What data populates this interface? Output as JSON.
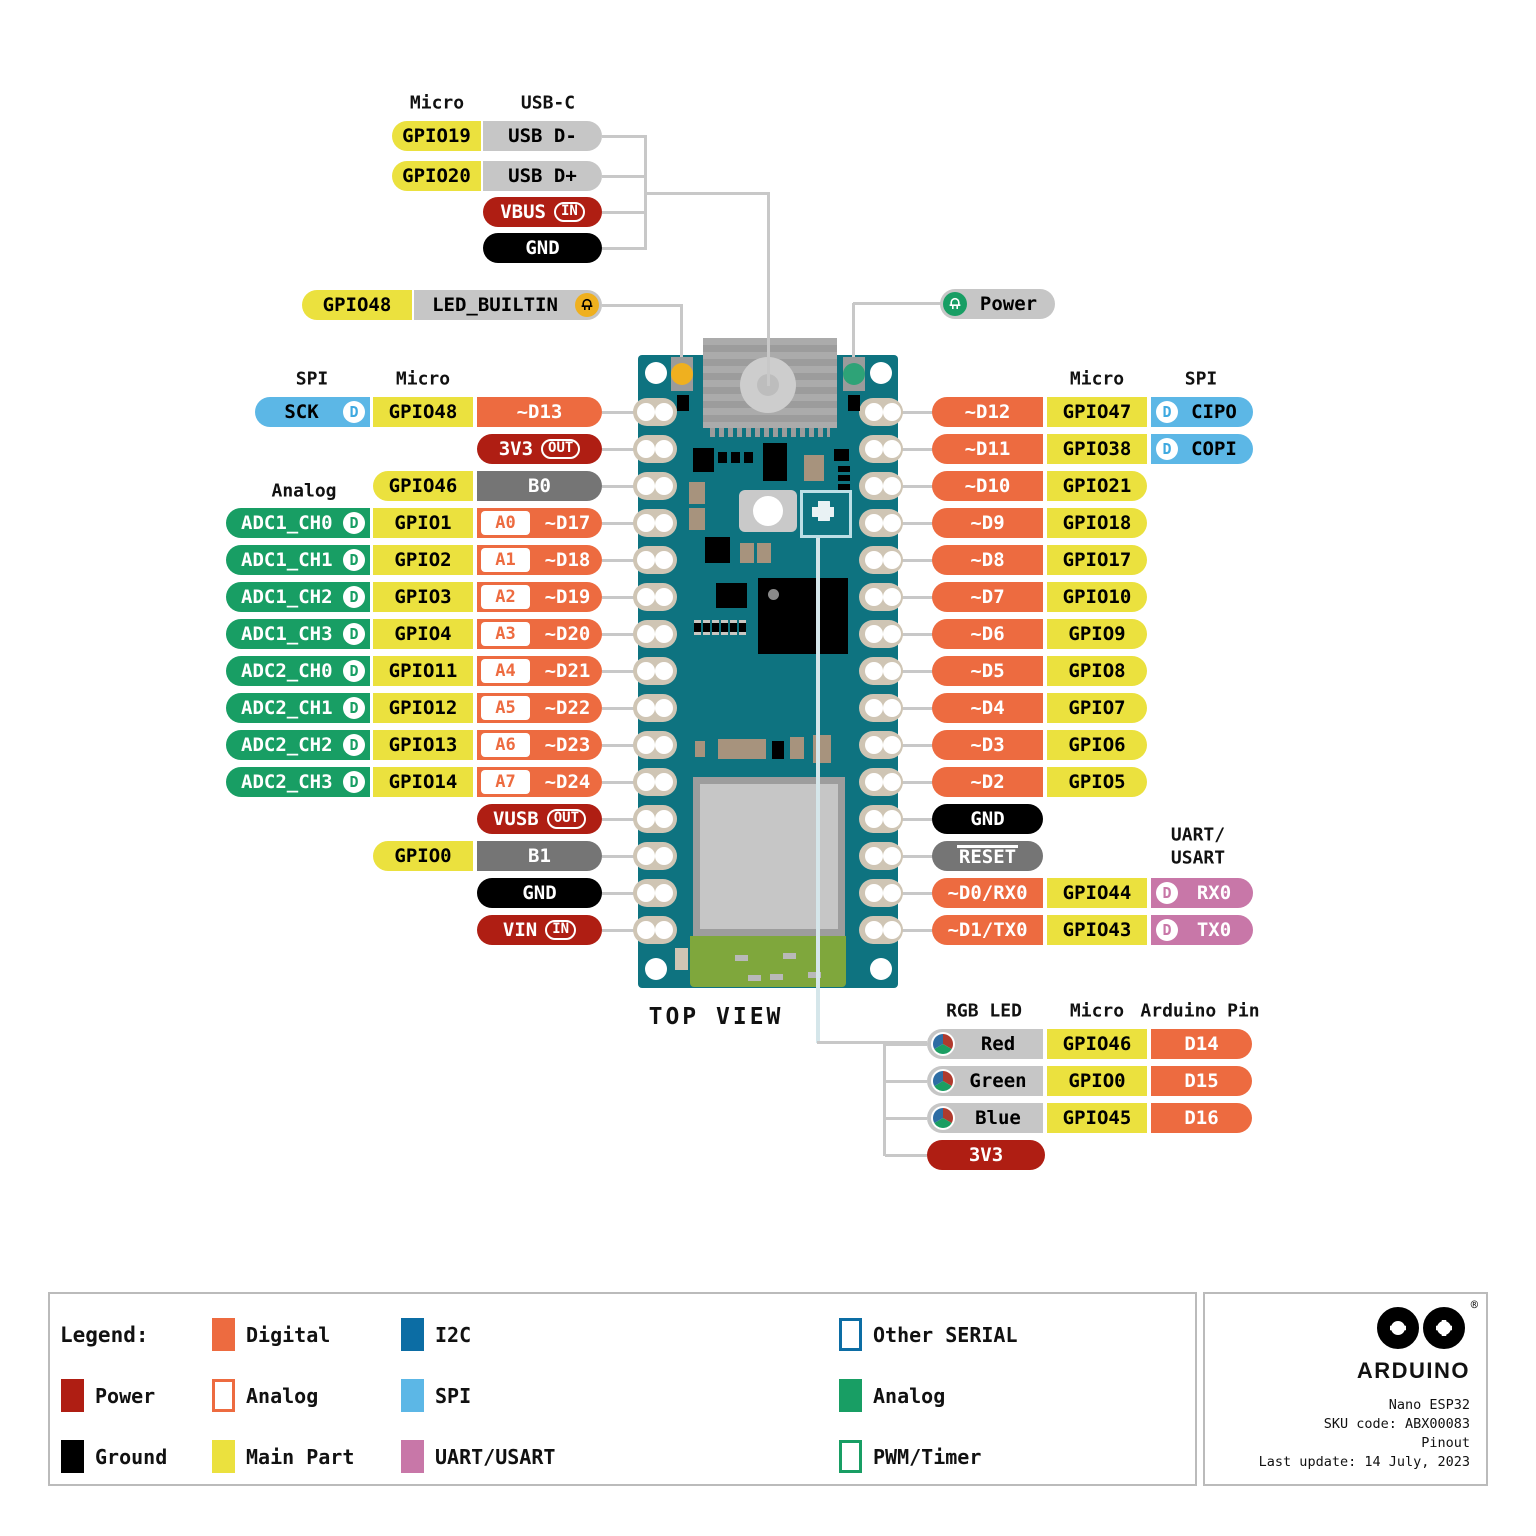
{
  "colors": {
    "digital": "#ED6B40",
    "main_part": "#EBE13E",
    "analog": "#189E64",
    "power": "#AF1E13",
    "ground": "#000000",
    "neutral_gray": "#757575",
    "label_gray": "#C6C6C6",
    "spi": "#5CB7E6",
    "i2c": "#0C6DA4",
    "uart": "#C877A8",
    "board_teal": "#0E7380",
    "wire_gray": "#C8C8C8",
    "pad_tan": "#CFC5B4",
    "led_amber": "#EFB01F",
    "led_green": "#2EA377",
    "antenna_green": "#7FA73C"
  },
  "top": {
    "col_headers": [
      "Micro",
      "USB-C"
    ],
    "rows": [
      {
        "micro": "GPIO19",
        "pin": "USB D-",
        "type": "gray"
      },
      {
        "micro": "GPIO20",
        "pin": "USB D+",
        "type": "gray"
      },
      {
        "pin": "VBUS",
        "badge": "IN",
        "type": "power"
      },
      {
        "pin": "GND",
        "type": "ground"
      }
    ],
    "led_row": {
      "micro": "GPIO48",
      "pin": "LED_BUILTIN"
    },
    "power_pill": "Power"
  },
  "left": {
    "group_headers": {
      "spi": "SPI",
      "micro": "Micro",
      "analog": "Analog"
    },
    "rows": [
      {
        "bus": "SCK",
        "bus_type": "spi",
        "micro": "GPIO48",
        "pin": "~D13"
      },
      {
        "pin": "3V3",
        "badge": "OUT",
        "type": "power"
      },
      {
        "micro": "GPIO46",
        "pin": "B0",
        "type": "gray2"
      },
      {
        "bus": "ADC1_CH0",
        "bus_type": "analog",
        "micro": "GPIO1",
        "abox": "A0",
        "pin": "~D17"
      },
      {
        "bus": "ADC1_CH1",
        "bus_type": "analog",
        "micro": "GPIO2",
        "abox": "A1",
        "pin": "~D18"
      },
      {
        "bus": "ADC1_CH2",
        "bus_type": "analog",
        "micro": "GPIO3",
        "abox": "A2",
        "pin": "~D19"
      },
      {
        "bus": "ADC1_CH3",
        "bus_type": "analog",
        "micro": "GPIO4",
        "abox": "A3",
        "pin": "~D20"
      },
      {
        "bus": "ADC2_CH0",
        "bus_type": "analog",
        "micro": "GPIO11",
        "abox": "A4",
        "pin": "~D21"
      },
      {
        "bus": "ADC2_CH1",
        "bus_type": "analog",
        "micro": "GPIO12",
        "abox": "A5",
        "pin": "~D22"
      },
      {
        "bus": "ADC2_CH2",
        "bus_type": "analog",
        "micro": "GPIO13",
        "abox": "A6",
        "pin": "~D23"
      },
      {
        "bus": "ADC2_CH3",
        "bus_type": "analog",
        "micro": "GPIO14",
        "abox": "A7",
        "pin": "~D24"
      },
      {
        "pin": "VUSB",
        "badge": "OUT",
        "type": "power"
      },
      {
        "micro": "GPIO0",
        "pin": "B1",
        "type": "gray2"
      },
      {
        "pin": "GND",
        "type": "ground"
      },
      {
        "pin": "VIN",
        "badge": "IN",
        "type": "power"
      }
    ]
  },
  "right": {
    "group_headers": {
      "micro": "Micro",
      "spi": "SPI",
      "uart_line1": "UART/",
      "uart_line2": "USART"
    },
    "rows": [
      {
        "pin": "~D12",
        "micro": "GPIO47",
        "bus": "CIPO",
        "bus_type": "spi"
      },
      {
        "pin": "~D11",
        "micro": "GPIO38",
        "bus": "COPI",
        "bus_type": "spi"
      },
      {
        "pin": "~D10",
        "micro": "GPIO21"
      },
      {
        "pin": "~D9",
        "micro": "GPIO18"
      },
      {
        "pin": "~D8",
        "micro": "GPIO17"
      },
      {
        "pin": "~D7",
        "micro": "GPIO10"
      },
      {
        "pin": "~D6",
        "micro": "GPIO9"
      },
      {
        "pin": "~D5",
        "micro": "GPIO8"
      },
      {
        "pin": "~D4",
        "micro": "GPIO7"
      },
      {
        "pin": "~D3",
        "micro": "GPIO6"
      },
      {
        "pin": "~D2",
        "micro": "GPIO5"
      },
      {
        "pin": "GND",
        "type": "ground"
      },
      {
        "pin": "RESET",
        "type": "gray2",
        "overline": true
      },
      {
        "pin": "~D0/RX0",
        "micro": "GPIO44",
        "bus": "RX0",
        "bus_type": "uart"
      },
      {
        "pin": "~D1/TX0",
        "micro": "GPIO43",
        "bus": "TX0",
        "bus_type": "uart"
      }
    ]
  },
  "rgb": {
    "col_headers": [
      "RGB LED",
      "Micro",
      "Arduino Pin"
    ],
    "rows": [
      {
        "led": "Red",
        "micro": "GPIO46",
        "pin": "D14"
      },
      {
        "led": "Green",
        "micro": "GPIO0",
        "pin": "D15"
      },
      {
        "led": "Blue",
        "micro": "GPIO45",
        "pin": "D16"
      },
      {
        "pin": "3V3",
        "type": "power"
      }
    ]
  },
  "board_label": "TOP VIEW",
  "legend": {
    "title": "Legend:",
    "columns": [
      [
        {
          "label": "Power",
          "swatch": "power"
        },
        {
          "label": "Ground",
          "swatch": "ground"
        }
      ],
      [
        {
          "label": "Digital",
          "swatch": "digital"
        },
        {
          "label": "Analog",
          "swatch": "analog-outline"
        },
        {
          "label": "Main Part",
          "swatch": "main"
        }
      ],
      [
        {
          "label": "I2C",
          "swatch": "i2c"
        },
        {
          "label": "SPI",
          "swatch": "spi"
        },
        {
          "label": "UART/USART",
          "swatch": "uart"
        }
      ],
      [
        {
          "label": "Other SERIAL",
          "swatch": "serial-outline"
        },
        {
          "label": "Analog",
          "swatch": "analog-green"
        },
        {
          "label": "PWM/Timer",
          "swatch": "pwm-outline"
        }
      ]
    ]
  },
  "info": {
    "brand": "ARDUINO",
    "reg_mark": "®",
    "lines": [
      "Nano ESP32",
      "SKU code: ABX00083",
      "Pinout",
      "Last update: 14 July, 2023"
    ]
  }
}
